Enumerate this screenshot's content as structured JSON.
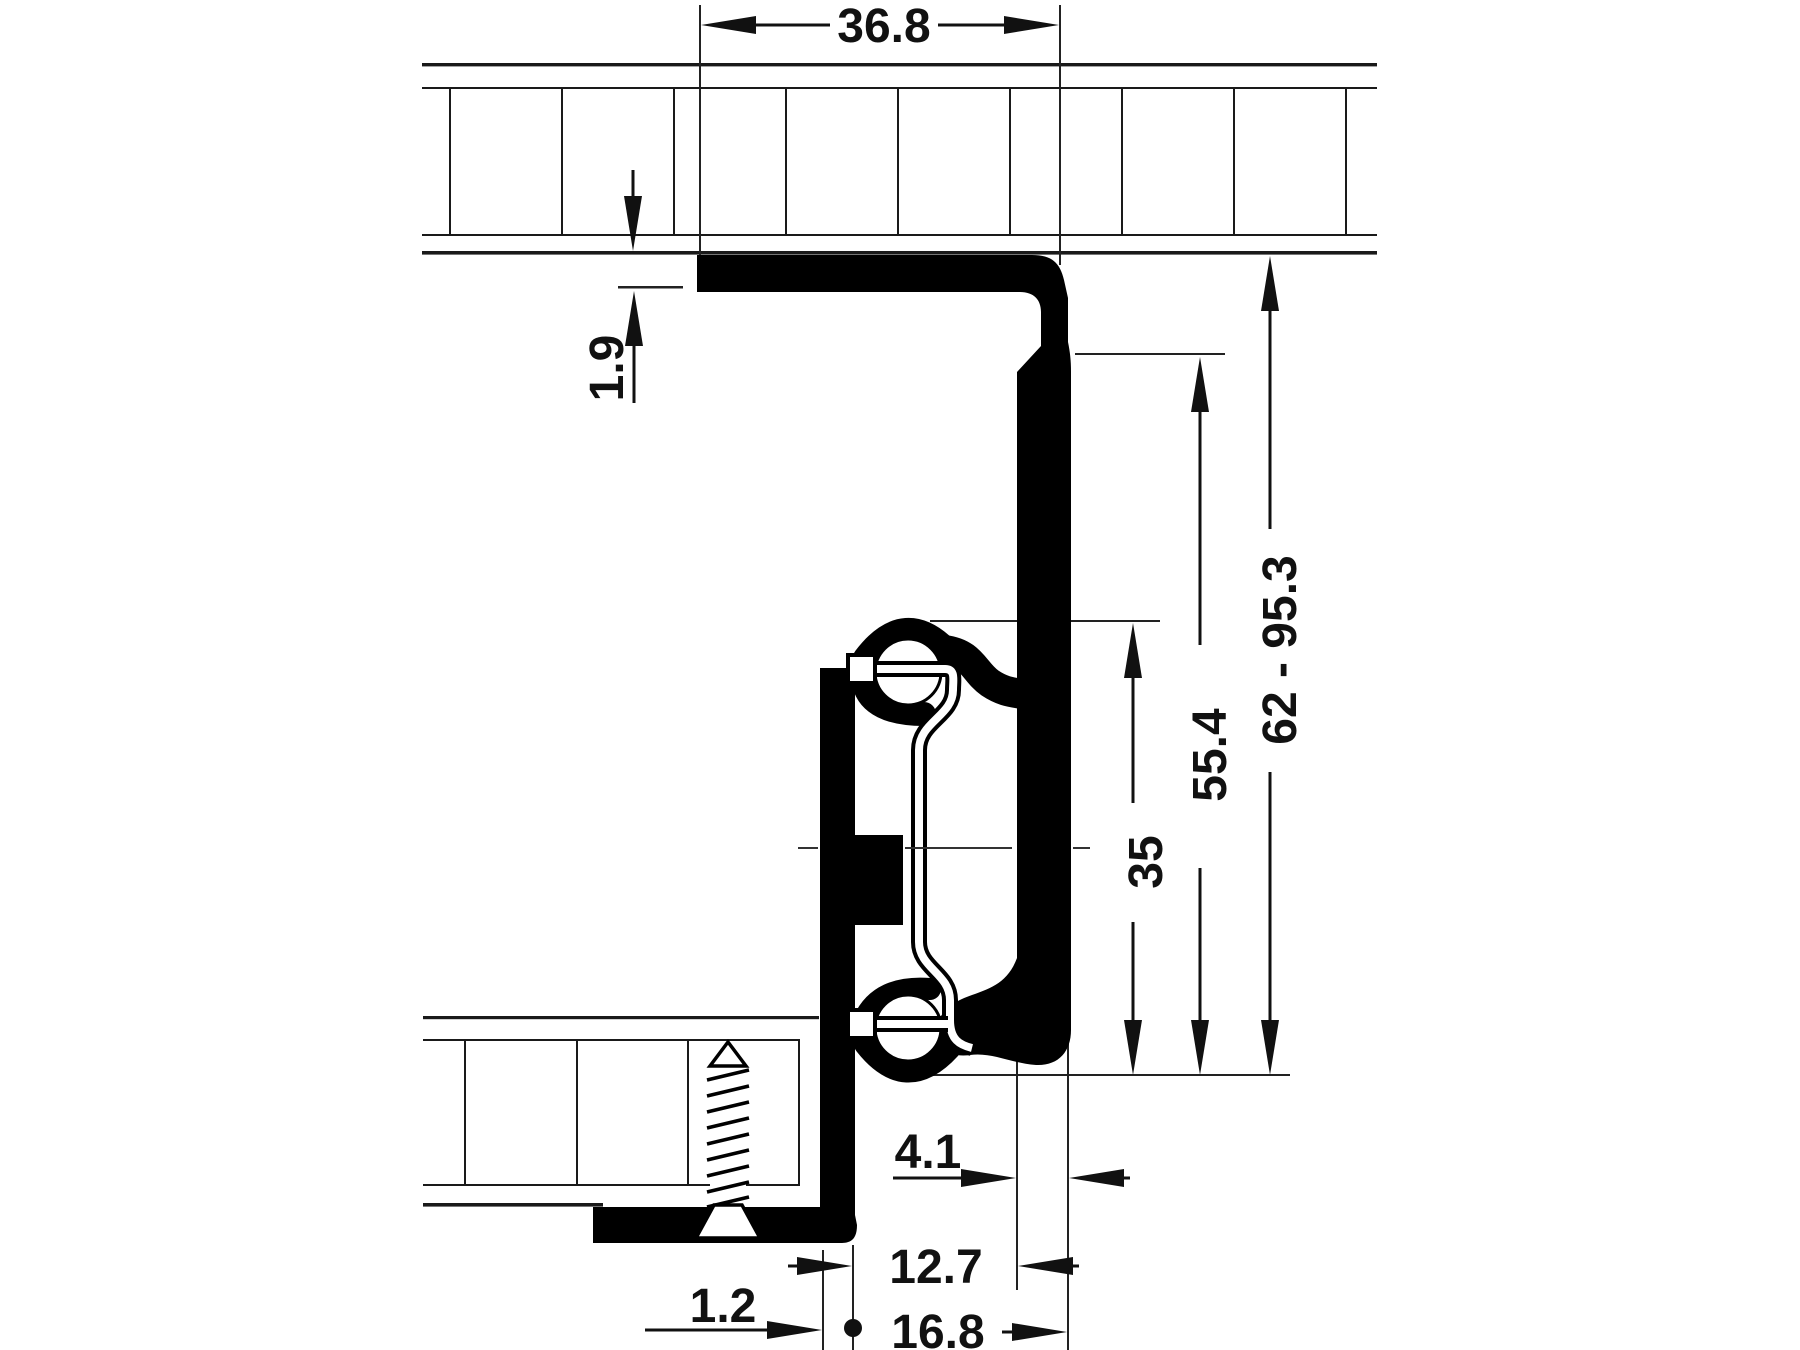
{
  "drawing": {
    "kind": "drawer-runner-cross-section",
    "ink_color": "#111111",
    "profile_color": "#000000",
    "background_color": "#ffffff",
    "dims": {
      "top_width": "36.8",
      "flange_thickness": "1.9",
      "height_range": "62 - 95.3",
      "rail_height": "55.4",
      "center_height": "35",
      "arm_width": "4.1",
      "offset_mid": "12.7",
      "offset_outer": "16.8",
      "edge_gap": "1.2"
    }
  }
}
